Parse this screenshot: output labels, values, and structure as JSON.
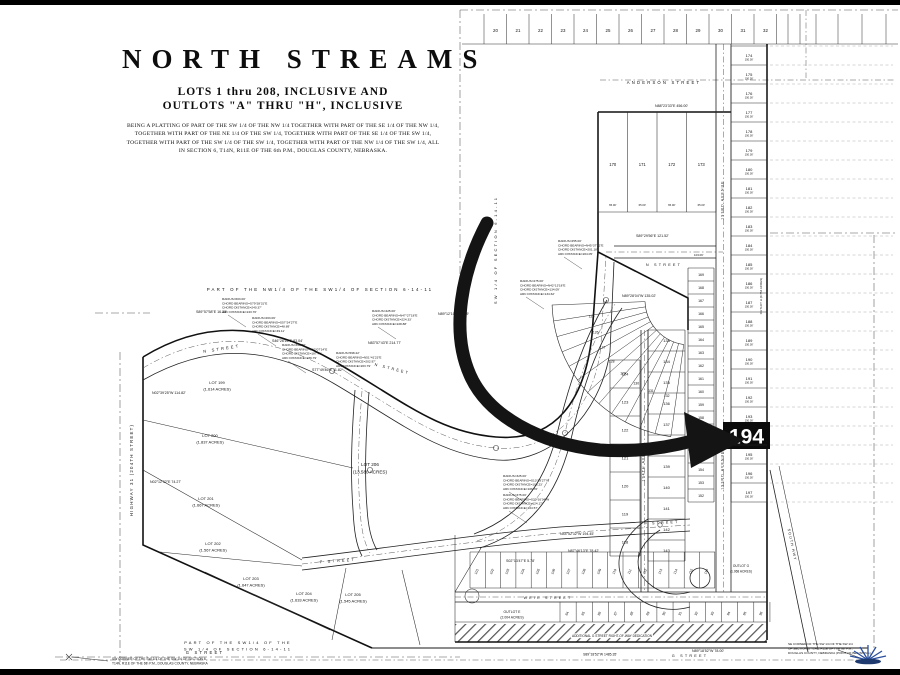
{
  "title_block": {
    "title": "NORTH STREAMS",
    "line1": "LOTS  1  thru  208,  INCLUSIVE  AND",
    "line2": "OUTLOTS  \"A\"  THRU  \"H\", INCLUSIVE",
    "legal": "BEING A PLATTING OF PART OF THE SW 1/4 OF THE NW 1/4 TOGETHER WITH PART OF THE SE 1/4 OF THE NW 1/4, TOGETHER WITH PART OF THE NE 1/4 OF THE SW 1/4, TOGETHER WITH PART OF THE SE 1/4 OF THE SW 1/4, TOGETHER WITH PART OF THE SW 1/4 OF THE SW 1/4, TOGETHER WITH PART OF THE NW 1/4 OF THE SW 1/4, ALL IN SECTION 6, T14N, R11E OF THE 6th P.M., DOUGLAS COUNTY, NEBRASKA."
  },
  "highlight": {
    "lot": "194"
  },
  "streets": {
    "n_street": "N  STREET",
    "p_street": "P  STREET",
    "weir": "WEIR  STREET",
    "g_street": "G  STREET",
    "anderson": "ANDERSON  STREET",
    "ave_193": "193RD  AVENUE",
    "ave_194": "194TH  AVENUE",
    "highway31": "HIGHWAY  31  (204TH  STREET)",
    "south_hwy": "SOUTH  HWY"
  },
  "section_labels": {
    "nw": "PART  OF  THE  NW1/4  OF  THE  SW1/4  OF  SECTION  6-14-11",
    "sw1": "PART  OF  THE  SW1/4  OF  THE",
    "sw2": "SW 1/4  OF  SECTION  6-14-11",
    "west_vert": "SW 1/4  OF  SECTION  6-14-11"
  },
  "corner_notes": {
    "sw1": "SW CORNER OF THE SW 1/4 OF THE SW 1/4 OF SECTION 6,",
    "sw2": "T14N, R11E OF THE 6th P.M., DOUGLAS COUNTY, NEBRASKA",
    "se1": "SE CORNER OF THE SW 1/4 OF THE SW 1/4",
    "se2": "OF SECTION 6, T14N, R11E OF THE 6th P.M.,",
    "se3": "DOUGLAS COUNTY, NEBRASKA (POINT OF BEGINNING)",
    "dedication": "ADDITIONAL   G   STREET   RIGHT-OF-WAY   DEDICATION",
    "g_dim": "S89°18'52\"W  1485.35'"
  },
  "big_lots": [
    {
      "name": "LOT  199",
      "acres": "(1.614 ACRES)"
    },
    {
      "name": "LOT  200",
      "acres": "(1.837 ACRES)"
    },
    {
      "name": "LOT  201",
      "acres": "(1.667 ACRES)"
    },
    {
      "name": "LOT  202",
      "acres": "(1.567 ACRES)"
    },
    {
      "name": "LOT  203",
      "acres": "(1.647 ACRES)"
    },
    {
      "name": "LOT  204",
      "acres": "(1.633 ACRES)"
    },
    {
      "name": "LOT  205",
      "acres": "(1.545 ACRES)"
    },
    {
      "name": "LOT  206",
      "acres": "(13.580 ACRES)"
    }
  ],
  "outlots": [
    {
      "name": "OUTLOT  E",
      "acres": "(2.004 ACRES)"
    },
    {
      "name": "OUTLOT  G",
      "acres": "(1.068 ACRES)"
    },
    {
      "name": "OUTLOT H (0.754 ACRES)",
      "acres": ""
    }
  ],
  "lot_grids": {
    "top_row": [
      "20",
      "21",
      "22",
      "23",
      "24",
      "25",
      "26",
      "27",
      "28",
      "29",
      "30",
      "31",
      "32"
    ],
    "ne_row": [
      "170",
      "171",
      "172",
      "173"
    ],
    "col_r1": [
      "169",
      "168",
      "167",
      "166",
      "165",
      "164",
      "163",
      "162",
      "161",
      "160",
      "159",
      "158",
      "157",
      "156",
      "155",
      "154",
      "153",
      "152"
    ],
    "col_r2": [
      "174",
      "175",
      "176",
      "177",
      "178",
      "179",
      "180",
      "181",
      "182",
      "183",
      "184",
      "185",
      "186",
      "187",
      "188",
      "189",
      "190",
      "191",
      "192",
      "193",
      "194",
      "195",
      "196",
      "197"
    ],
    "col_m": [
      "133",
      "134",
      "135",
      "136",
      "137",
      "138",
      "139",
      "140",
      "141",
      "142",
      "143"
    ],
    "col_l2": [
      "124",
      "123",
      "122",
      "121",
      "120",
      "119",
      "118"
    ],
    "fan": [
      "125",
      "126",
      "127",
      "128",
      "129",
      "130",
      "131",
      "132"
    ],
    "row_upper": [
      "101",
      "102",
      "103",
      "104",
      "105",
      "106",
      "107",
      "108",
      "109",
      "110",
      "111",
      "112",
      "113",
      "114",
      "115",
      "116"
    ],
    "row_lower": [
      "84",
      "85",
      "86",
      "87",
      "88",
      "89",
      "90",
      "91",
      "92",
      "93",
      "94",
      "95",
      "96"
    ]
  },
  "dims": {
    "r2_width": "150.00'",
    "ne_lot": "65.00'",
    "anderson": "103.06'"
  },
  "bearings": [
    "S89°57'58\"E  16.33'",
    "N88°23'33\"E  456.00'",
    "N89°12'10\"E  70.09'",
    "N83°57'43\"E  214.77'",
    "S46°26'16\"E  83.04'",
    "S77°49'46\"E  11.82'",
    "S89°29'56\"E  121.52'",
    "N89°28'04\"W  135.02'",
    "N44°52'32\"W  194.45'",
    "N87°46'13\"E  78.42'",
    "S02°13'47\"E  5.78'",
    "N02°39'25\"W  114.82'",
    "N02°12'32\"E  74.27'",
    "N89°18'52\"W  78.00'"
  ],
  "curve_notes": [
    {
      "lines": [
        "RADIUS=603.00'",
        "CHORD BEARING=S79°28'31\"E",
        "CHORD DISTANCE=240.37'",
        "ARC DISTANCE=243.70'"
      ]
    },
    {
      "lines": [
        "RADIUS=263.06'",
        "CHORD BEARING=S57°24'27\"E",
        "CHORD DISTANCE=48.89'",
        "ARC DISTANCE=49.11'"
      ]
    },
    {
      "lines": [
        "RADIUS=396.00'",
        "CHORD BEARING=S62°07'14\"E",
        "CHORD DISTANCE=187.49'",
        "ARC DISTANCE=189.79'"
      ]
    },
    {
      "lines": [
        "RADIUS=598.22'",
        "CHORD BEARING=N51°41'23\"E",
        "CHORD DISTANCE=202.97'",
        "ARC DISTANCE=203.79'"
      ]
    },
    {
      "lines": [
        "RADIUS=425.00'",
        "CHORD BEARING=N47°27'18\"E",
        "CHORD DISTANCE=224.33'",
        "ARC DISTANCE=228.88'"
      ]
    },
    {
      "lines": [
        "RADIUS=255.00'",
        "CHORD BEARING=N45°37'12\"E",
        "CHORD DISTANCE=201.18'",
        "ARC DISTANCE=204.05'"
      ]
    },
    {
      "lines": [
        "RADIUS=275.00'",
        "CHORD BEARING=N42°13'18\"E",
        "CHORD DISTANCE=134.09'",
        "ARC DISTANCE=134.62'"
      ]
    },
    {
      "lines": [
        "RADIUS=325.00'",
        "CHORD BEARING=S13°19'27\"W",
        "CHORD DISTANCE=106.23'",
        "ARC DISTANCE=106.70'"
      ]
    },
    {
      "lines": [
        "RADIUS=375.00'",
        "CHORD BEARING=S20°16'34\"W",
        "CHORD DISTANCE=124.17'",
        "ARC DISTANCE=124.57'"
      ]
    }
  ],
  "logo": {
    "icon": "sunburst-logo"
  }
}
